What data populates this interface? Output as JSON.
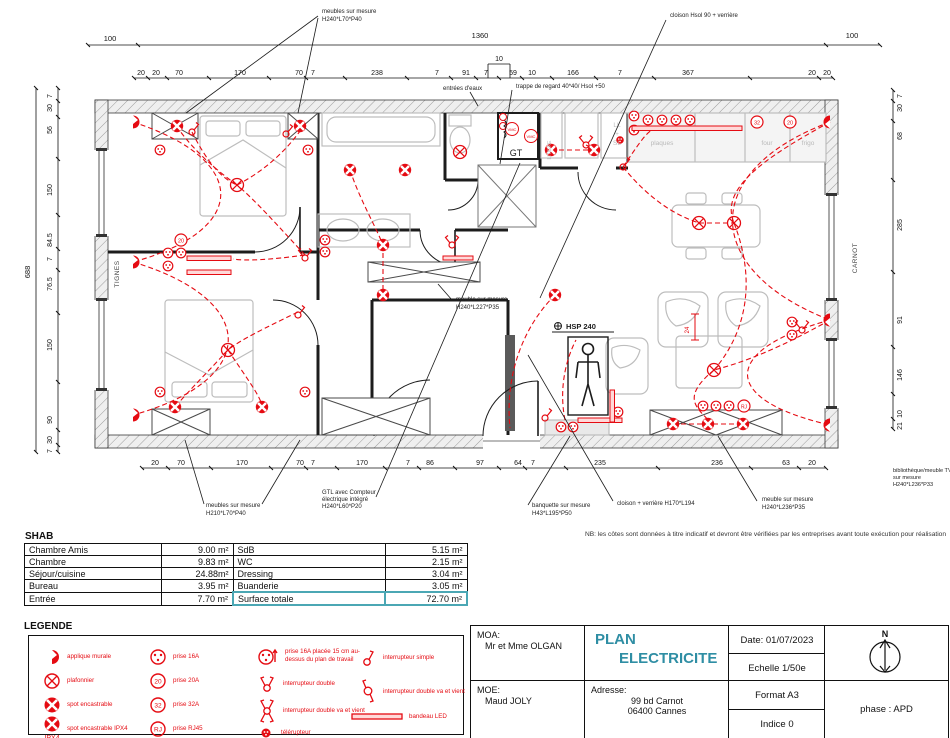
{
  "accent": {
    "red": "#e50b12",
    "teal": "#2f8ea4"
  },
  "plan": {
    "dims_top_overall": [
      "100",
      "1360",
      "100"
    ],
    "dims_top": [
      "20",
      "20",
      "70",
      "170",
      "70",
      "7",
      "238",
      "7",
      "91",
      "7",
      "59",
      "10",
      "166",
      "7",
      "367",
      "20",
      "20"
    ],
    "dims_top_raised": "10",
    "dims_bottom": [
      "20",
      "70",
      "170",
      "70",
      "7",
      "170",
      "7",
      "86",
      "97",
      "64",
      "7",
      "235",
      "236",
      "63",
      "20"
    ],
    "dims_left_total": "688",
    "dims_left": [
      "7",
      "30",
      "56",
      "150",
      "84.5",
      "7",
      "76.5",
      "150",
      "90",
      "30",
      "7"
    ],
    "dims_right": [
      "7",
      "30",
      "68",
      "285",
      "91",
      "146",
      "10",
      "21"
    ],
    "streets": {
      "left": "TIGNES",
      "right": "CARNOT"
    },
    "annotations": {
      "meubles_top_1": "meubles sur mesure",
      "meubles_top_2": "H240*L70*P40",
      "cloison_top": "cloison Hsol 90 + verrière",
      "entrees_eaux": "entrées d'eaux",
      "trappe": "trappe de regard 40*40/ Hsol +50",
      "meuble_mid_1": "meuble sur mesure",
      "meuble_mid_2": "H240*L227*P35",
      "hsp": "HSP 240",
      "meubles_bottom_1": "meubles sur mesure",
      "meubles_bottom_2": "H210*L70*P40",
      "gtl_1": "GTL avec Compteur",
      "gtl_2": "électrique intégré",
      "gtl_3": "H240*L60*P20",
      "banquette_1": "banquette sur mesure",
      "banquette_2": "H43*L195*P50",
      "cloison_bottom": "cloison + verrière H170*L194",
      "meuble_bottom_1": "meuble sur mesure",
      "meuble_bottom_2": "H240*L236*P35",
      "biblio_1": "bibliothèque/meuble TV",
      "biblio_2": "sur mesure",
      "biblio_3": "H240*L236*P33",
      "dim24": "24"
    },
    "labels": {
      "gt": "GT",
      "vmc": "VMC",
      "plaques": "plaques",
      "four": "four",
      "frigo": "frigo",
      "ll": "LL",
      "plus": "+",
      "sl": "SL",
      "litiere": "LITIERE"
    }
  },
  "shab": {
    "title": "SHAB",
    "rows": [
      [
        "Chambre Amis",
        "9.00 m²",
        "SdB",
        "5.15 m²"
      ],
      [
        "Chambre",
        "9.83 m²",
        "WC",
        "2.15 m²"
      ],
      [
        "Séjour/cuisine",
        "24.88m²",
        "Dressing",
        "3.04 m²"
      ],
      [
        "Bureau",
        "3.95 m²",
        "Buanderie",
        "3.05 m²"
      ],
      [
        "Entrée",
        "7.70 m²",
        "Surface totale",
        "72.70 m²"
      ]
    ]
  },
  "nb_note": "NB: les côtes sont données à titre indicatif et devront être vérifiées par les entreprises avant toute exécution pour réalisation",
  "legend": {
    "title": "LEGENDE",
    "col1": [
      {
        "label": "applique murale"
      },
      {
        "label": "plafonnier"
      },
      {
        "label": "spot encastrable"
      },
      {
        "label": "spot encastrable IPX4",
        "sub": "IPX4"
      }
    ],
    "col2": [
      {
        "label": "prise 16A"
      },
      {
        "badge": "20",
        "label": "prise 20A"
      },
      {
        "badge": "32",
        "label": "prise 32A"
      },
      {
        "badge": "RJ",
        "label": "prise RJ45"
      }
    ],
    "col3": [
      {
        "label": "prise 16A placée 15 cm au-dessus du plan de travail"
      },
      {
        "label": "interrupteur double"
      },
      {
        "label": "interrupteur double va et vient"
      },
      {
        "label": "télérupteur"
      }
    ],
    "col4": [
      {
        "label": "interrupteur simple"
      },
      {
        "label": "interrupteur double va et vient"
      },
      {
        "label": "bandeau LED"
      }
    ]
  },
  "titleblock": {
    "moa_label": "MOA:",
    "moa_value": "Mr et Mme OLGAN",
    "moe_label": "MOE:",
    "moe_value": "Maud JOLY",
    "title_line1": "PLAN",
    "title_line2": "ELECTRICITE",
    "adresse_label": "Adresse:",
    "adresse_line1": "99 bd Carnot",
    "adresse_line2": "06400 Cannes",
    "date": "Date: 01/07/2023",
    "echelle": "Echelle 1/50e",
    "format": "Format A3",
    "indice": "Indice 0",
    "phase": "phase : APD",
    "north": "N"
  }
}
